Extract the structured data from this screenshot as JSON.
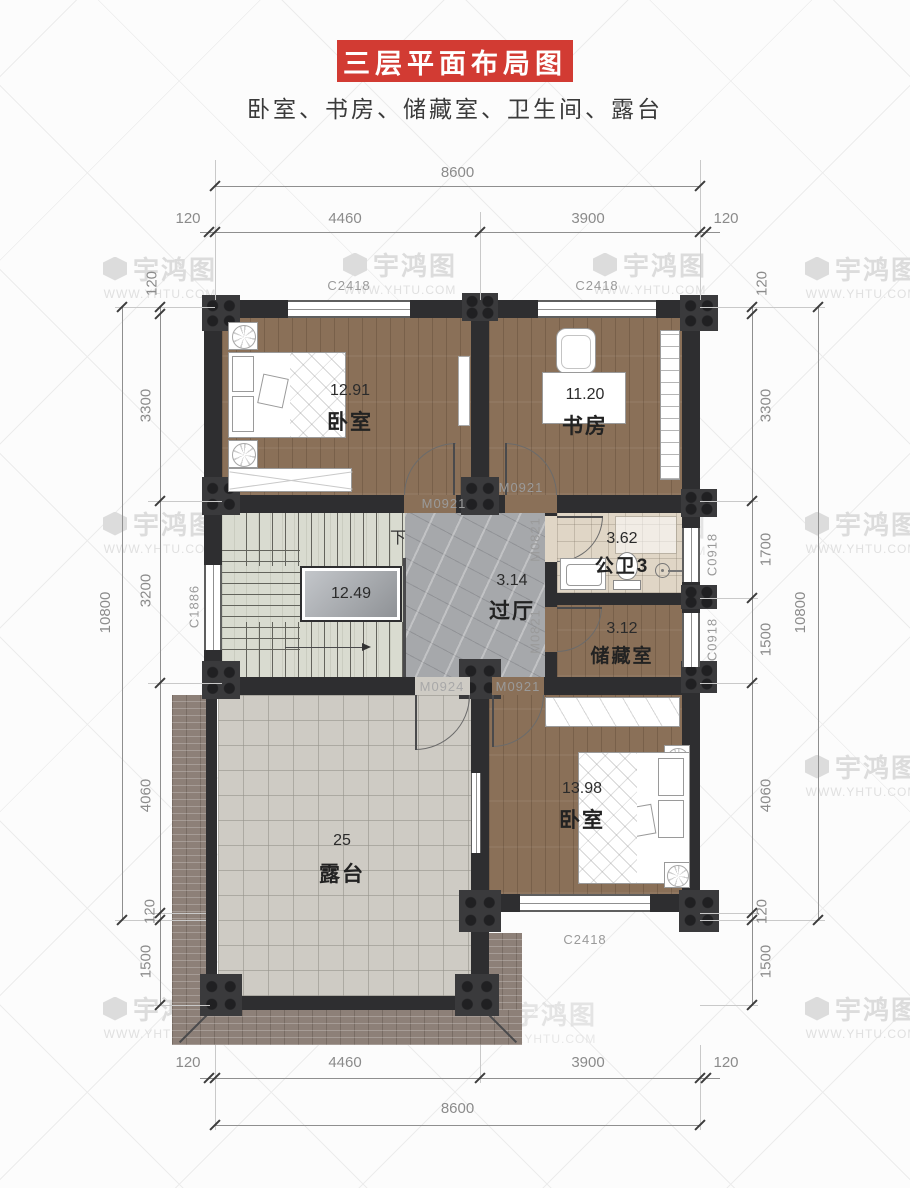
{
  "header": {
    "title": "三层平面布局图",
    "subtitle": "卧室、书房、储藏室、卫生间、露台"
  },
  "watermark": {
    "brand": "宇鸿图",
    "url": "WWW.YHTU.COM"
  },
  "rooms": {
    "bedroom1": {
      "name": "卧室",
      "area": "12.91"
    },
    "study": {
      "name": "书房",
      "area": "11.20"
    },
    "stairwell": {
      "area": "12.49",
      "down": "下"
    },
    "hall": {
      "name": "过厅",
      "area": "3.14"
    },
    "bath": {
      "name": "公卫3",
      "area": "3.62"
    },
    "storage": {
      "name": "储藏室",
      "area": "3.12"
    },
    "bedroom2": {
      "name": "卧室",
      "area": "13.98"
    },
    "terrace": {
      "name": "露台",
      "area": "25"
    }
  },
  "openings": {
    "windows": {
      "top_left": "C2418",
      "top_right": "C2418",
      "stair": "C1886",
      "bath": "C0918",
      "storage": "C0918",
      "bottom": "C2418"
    },
    "doors": {
      "bedroom1": "M0921",
      "study": "M0921",
      "bath": "M0821",
      "storage": "M0821",
      "terrace": "M0924",
      "bedroom2": "M0921"
    }
  },
  "dims": {
    "top": {
      "total": "8600",
      "segs": [
        "120",
        "4460",
        "3900",
        "120"
      ]
    },
    "bottom": {
      "total": "8600",
      "segs": [
        "120",
        "4460",
        "3900",
        "120"
      ]
    },
    "left": {
      "total": "10800",
      "segs": [
        "120",
        "3300",
        "3200",
        "4060",
        "120",
        "1500"
      ]
    },
    "right": {
      "total": "10800",
      "segs": [
        "120",
        "3300",
        "1700",
        "1500",
        "4060",
        "120",
        "1500"
      ]
    }
  },
  "colors": {
    "accent_red": "#d23b33",
    "wall": "#2e2e30",
    "wood_floor": "#8a7058",
    "marble_floor": "#a6a8ab",
    "stair_floor": "#d9dbd0",
    "bath_tile": "#e0d6c6",
    "terrace_tile": "#cecbc4",
    "brick_eave": "#8d8078"
  }
}
